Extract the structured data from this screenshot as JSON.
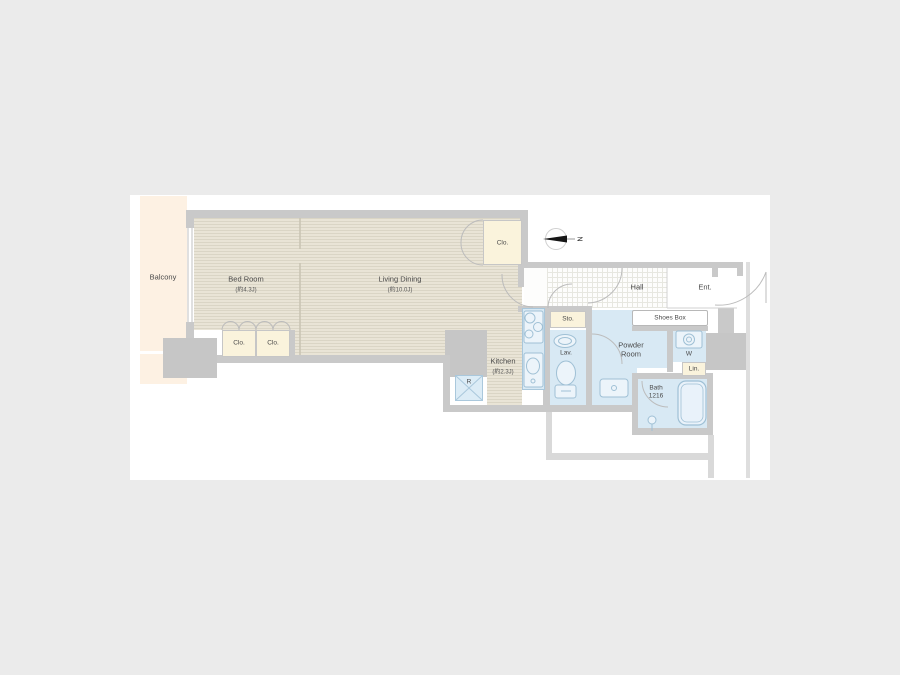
{
  "page": {
    "background": "#ebebeb",
    "plan_background": "#ffffff"
  },
  "colors": {
    "wall": "#c9c9c9",
    "floor_tatami": "#e9e4d6",
    "balcony": "#fdf1e3",
    "closet_fill": "#faf3dc",
    "wet_area_fill": "#d8e9f4",
    "fixture_stroke": "#9fc0d5",
    "door_arc_stroke": "#bcbcbc",
    "label_text": "#4a4a4a"
  },
  "compass": {
    "north_label": "N"
  },
  "rooms": {
    "balcony": {
      "label": "Balcony"
    },
    "bed_room": {
      "label": "Bed Room",
      "size": "(約4.3J)"
    },
    "living_dining": {
      "label": "Living Dining",
      "size": "(約10.0J)"
    },
    "kitchen": {
      "label": "Kitchen",
      "size": "(約2.3J)"
    },
    "hall": {
      "label": "Hall"
    },
    "entrance": {
      "label": "Ent."
    },
    "closet_hall": {
      "label": "Clo."
    },
    "closet_bedroom_left": {
      "label": "Clo."
    },
    "closet_bedroom_right": {
      "label": "Clo."
    },
    "storage": {
      "label": "Sto."
    },
    "lavatory": {
      "label": "Lav."
    },
    "powder_room": {
      "label": "Powder Room"
    },
    "washer": {
      "label": "W"
    },
    "linen": {
      "label": "Lin."
    },
    "refrigerator": {
      "label": "R"
    },
    "bath": {
      "label": "Bath",
      "size": "1216"
    },
    "shoes_box": {
      "label": "Shoes Box"
    }
  }
}
